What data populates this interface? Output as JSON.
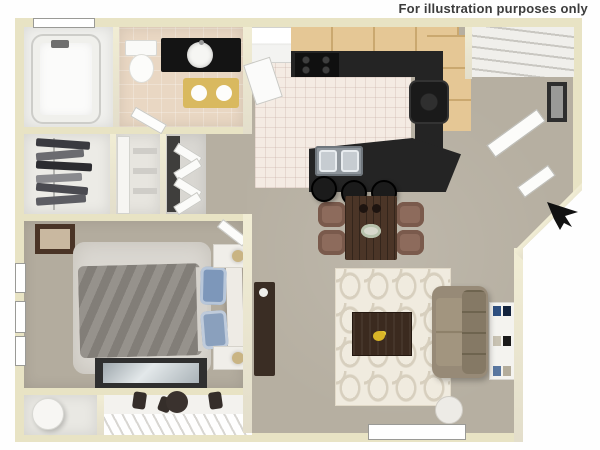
{
  "disclaimer": "For illustration purposes only",
  "icons": {
    "cursor": "nw-arrow-cursor"
  },
  "colors": {
    "background": "#fefefe",
    "wall": "#e8e3c4",
    "carpet": "#b6afa1",
    "bedroom_carpet": "#b3ac9e",
    "kitchen_floor": "#f4ebe3",
    "bath_floor": "#e9d7c3",
    "closet_floor": "#ecebe6",
    "white_floor": "#f1f1ee",
    "patio_floor": "#f3f2ee",
    "cabinet": "#e5c795",
    "counter": "#242424",
    "vanity": "#141414",
    "bath_mat": "#d9b95f",
    "bed": "#8c8781",
    "pillow": "#7d97ba",
    "fluffy_rug": "#dad7d1",
    "dining_table": "#4b3527",
    "dining_chair": "#8d6b5c",
    "sofa": "#978a77",
    "trellis_rug": "#f0ebdf",
    "coffee_table": "#3b2a1f",
    "tv_stand": "#3a2d24",
    "flowers": "#d8b427",
    "cursor": "#111111"
  },
  "scene": {
    "type": "apartment-floor-plan",
    "view": "3d-top-down",
    "rooms": [
      {
        "name": "Bathroom",
        "furniture": [
          "bathtub",
          "toilet",
          "vanity with round sink",
          "gold bath mat"
        ]
      },
      {
        "name": "Walk-in closet",
        "furniture": [
          "clothes rod",
          "hanging clothes"
        ]
      },
      {
        "name": "Linen closet",
        "furniture": [
          "door",
          "shelves"
        ]
      },
      {
        "name": "Laundry closet",
        "furniture": [
          "bifold doors"
        ]
      },
      {
        "name": "Bedroom",
        "furniture": [
          "bed with gray comforter",
          "blue pillows",
          "two nightstands with lamps",
          "white area rug",
          "wall art",
          "glass-top dresser",
          "three windows"
        ]
      },
      {
        "name": "Patio",
        "furniture": [
          "railing",
          "round patio table",
          "patio chairs",
          "storage room",
          "water heater"
        ]
      },
      {
        "name": "Kitchen",
        "furniture": [
          "refrigerator",
          "range",
          "tan cabinets",
          "black counters",
          "cooktop",
          "breakfast bar island",
          "double stainless sink",
          "three bar stools"
        ]
      },
      {
        "name": "Dining area",
        "furniture": [
          "dark wood table",
          "four upholstered chairs",
          "table setting"
        ]
      },
      {
        "name": "Living room",
        "furniture": [
          "sofa",
          "coffee table with flowers",
          "trellis-pattern rug",
          "tv stand",
          "bookshelf",
          "round side table",
          "window"
        ]
      },
      {
        "name": "Entry",
        "furniture": [
          "coat closet shelves",
          "front door",
          "framed wall art",
          "angled wall"
        ]
      }
    ]
  }
}
